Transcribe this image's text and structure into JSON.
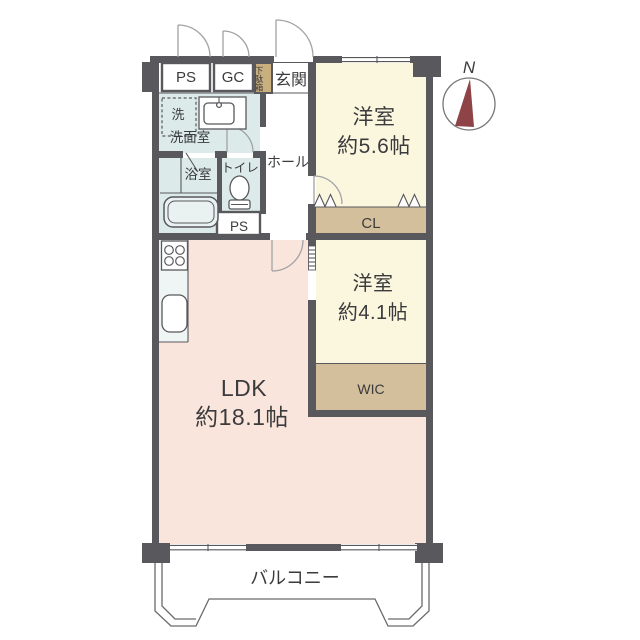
{
  "colors": {
    "wall": "#59585c",
    "western_room": "#fbf7df",
    "ldk": "#fae5dc",
    "wet_area": "#dcebe9",
    "kitchen": "#eef5f4",
    "closet": "#d3bf9b",
    "shoe_cabinet": "#c9ae7e",
    "compass_needle": "#8e4347",
    "text": "#3b3b3d"
  },
  "labels": {
    "ps_top": "PS",
    "gc": "GC",
    "shoe_cabinet": "下駄箱",
    "entrance": "玄関",
    "washer": "洗",
    "washroom": "洗面室",
    "bathroom": "浴室",
    "toilet": "トイレ",
    "ps_lower": "PS",
    "hall": "ホール",
    "western1_name": "洋室",
    "western1_size": "約5.6帖",
    "closet": "CL",
    "western2_name": "洋室",
    "western2_size": "約4.1帖",
    "wic": "WIC",
    "ldk_name": "LDK",
    "ldk_size": "約18.1帖",
    "balcony": "バルコニー",
    "compass_north": "N"
  }
}
